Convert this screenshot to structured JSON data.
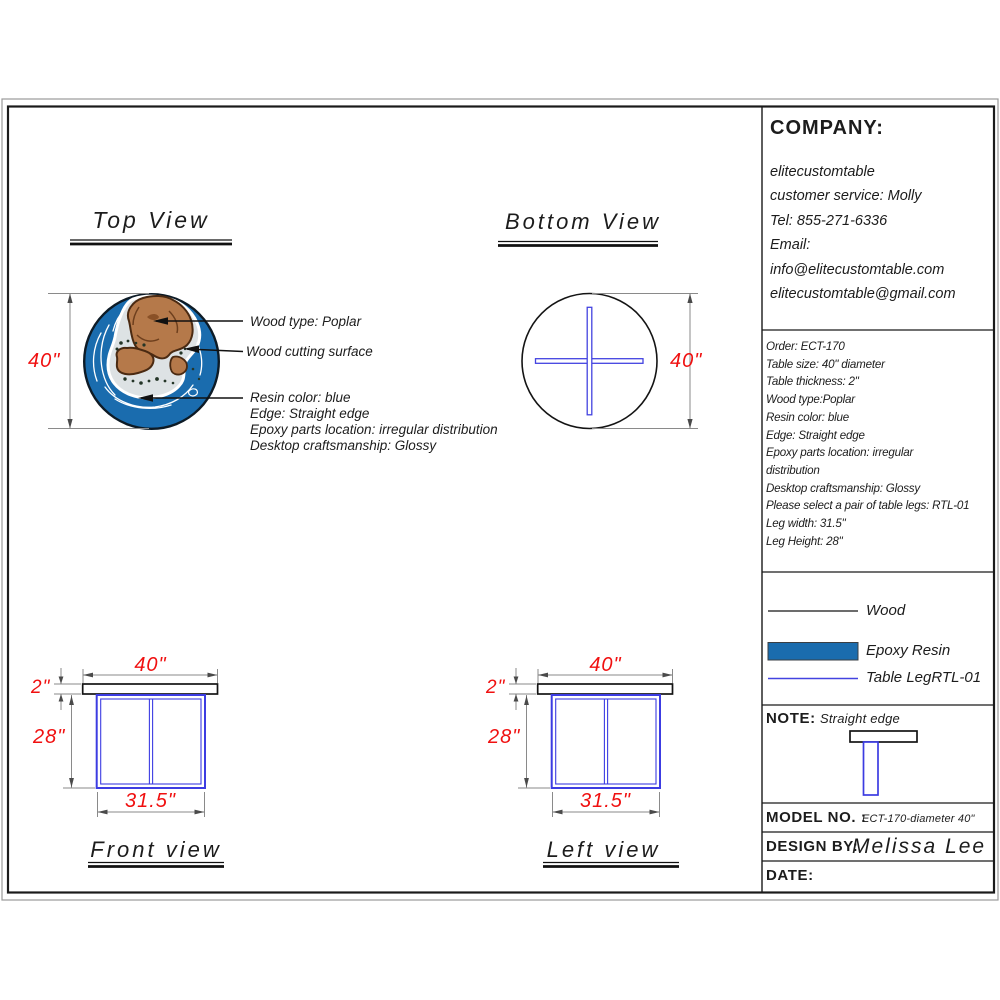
{
  "colors": {
    "dimension_red": "#f01010",
    "leg_blue": "#3c3ce2",
    "resin_blue": "#1a6cae",
    "wood_brown": "#b5794a"
  },
  "top_view": {
    "title": "Top View",
    "dim_diameter": "40\"",
    "callout_wood": "Wood type: Poplar",
    "callout_surface": "Wood cutting surface",
    "callout_resin_lines": [
      "Resin color: blue",
      "Edge: Straight edge",
      "Epoxy parts location: irregular distribution",
      "Desktop craftsmanship: Glossy"
    ]
  },
  "bottom_view": {
    "title": "Bottom View",
    "dim_diameter": "40\""
  },
  "front_view": {
    "title": "Front view",
    "dim_top": "40\"",
    "dim_thickness": "2\"",
    "dim_height": "28\"",
    "dim_leg_width": "31.5\""
  },
  "left_view": {
    "title": "Left view",
    "dim_top": "40\"",
    "dim_thickness": "2\"",
    "dim_height": "28\"",
    "dim_leg_width": "31.5\""
  },
  "company": {
    "label": "COMPANY:",
    "lines": [
      "elitecustomtable",
      "customer service: Molly",
      "Tel: 855-271-6336",
      "Email:",
      "info@elitecustomtable.com",
      "elitecustomtable@gmail.com"
    ]
  },
  "order": {
    "lines": [
      "Order: ECT-170",
      "Table size: 40\" diameter",
      "Table thickness: 2\"",
      "Wood type:Poplar",
      "Resin color: blue",
      "Edge: Straight edge",
      "Epoxy parts location: irregular",
      "distribution",
      "Desktop craftsmanship: Glossy",
      "Please select a pair of table legs: RTL-01",
      "Leg width: 31.5\"",
      "Leg Height: 28\""
    ]
  },
  "legend": {
    "wood": "Wood",
    "epoxy": "Epoxy Resin",
    "leg": "Table LegRTL-01"
  },
  "note": {
    "label": "NOTE:",
    "value": "Straight edge"
  },
  "title_block": {
    "model_label": "MODEL NO. :",
    "model_value": "ECT-170-diameter 40\"",
    "design_label": "DESIGN BY:",
    "design_value": "Melissa Lee",
    "date_label": "DATE:"
  }
}
